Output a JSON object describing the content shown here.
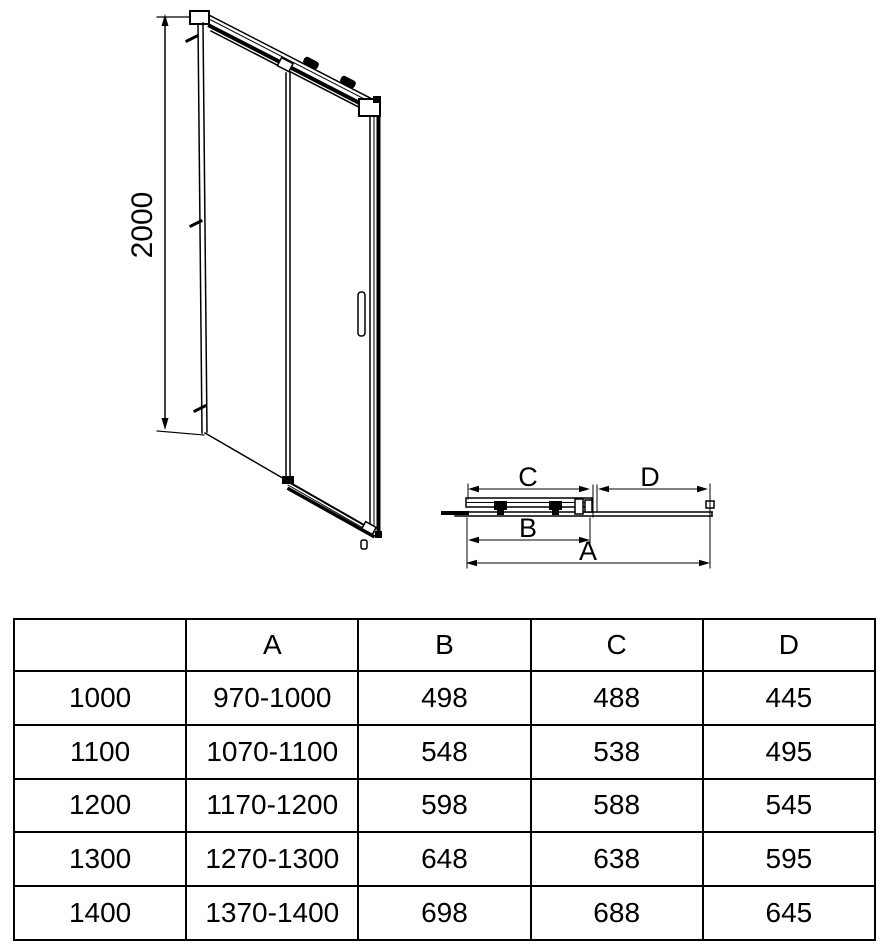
{
  "drawing": {
    "height_label": "2000",
    "dim_a": "A",
    "dim_b": "B",
    "dim_c": "C",
    "dim_d": "D"
  },
  "table": {
    "headers": [
      "",
      "A",
      "B",
      "C",
      "D"
    ],
    "rows": [
      {
        "cells": [
          "1000",
          "970-1000",
          "498",
          "488",
          "445"
        ]
      },
      {
        "cells": [
          "1100",
          "1070-1100",
          "548",
          "538",
          "495"
        ]
      },
      {
        "cells": [
          "1200",
          "1170-1200",
          "598",
          "588",
          "545"
        ]
      },
      {
        "cells": [
          "1300",
          "1270-1300",
          "648",
          "638",
          "595"
        ]
      },
      {
        "cells": [
          "1400",
          "1370-1400",
          "698",
          "688",
          "645"
        ]
      }
    ]
  }
}
